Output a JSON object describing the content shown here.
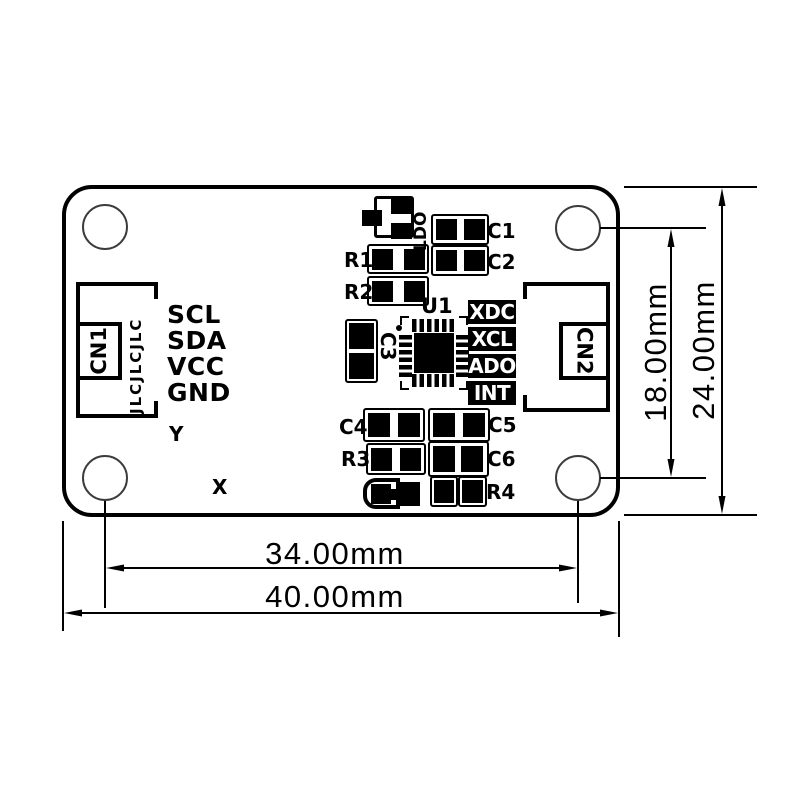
{
  "silkscreen": {
    "cn1": "CN1",
    "cn2": "CN2",
    "watermark": "JLCJLCJLC",
    "pins": [
      "SCL",
      "SDA",
      "VCC",
      "GND"
    ],
    "u1": "U1",
    "ldo": "LDO",
    "r1": "R1",
    "r2": "R2",
    "r3": "R3",
    "r4": "R4",
    "c1": "C1",
    "c2": "C2",
    "c3": "C3",
    "c4": "C4",
    "c5": "C5",
    "c6": "C6",
    "signal_pads": [
      "XDC",
      "XCL",
      "ADO",
      "INT"
    ],
    "axis_x": "X",
    "axis_y": "Y"
  },
  "dimensions": {
    "hole_pitch_vertical": "18.00mm",
    "board_height": "24.00mm",
    "hole_pitch_horizontal": "34.00mm",
    "board_width": "40.00mm"
  },
  "colors": {
    "ink": "#000000",
    "background": "#ffffff",
    "inverted_label_bg": "#000000",
    "inverted_label_text": "#ffffff"
  }
}
